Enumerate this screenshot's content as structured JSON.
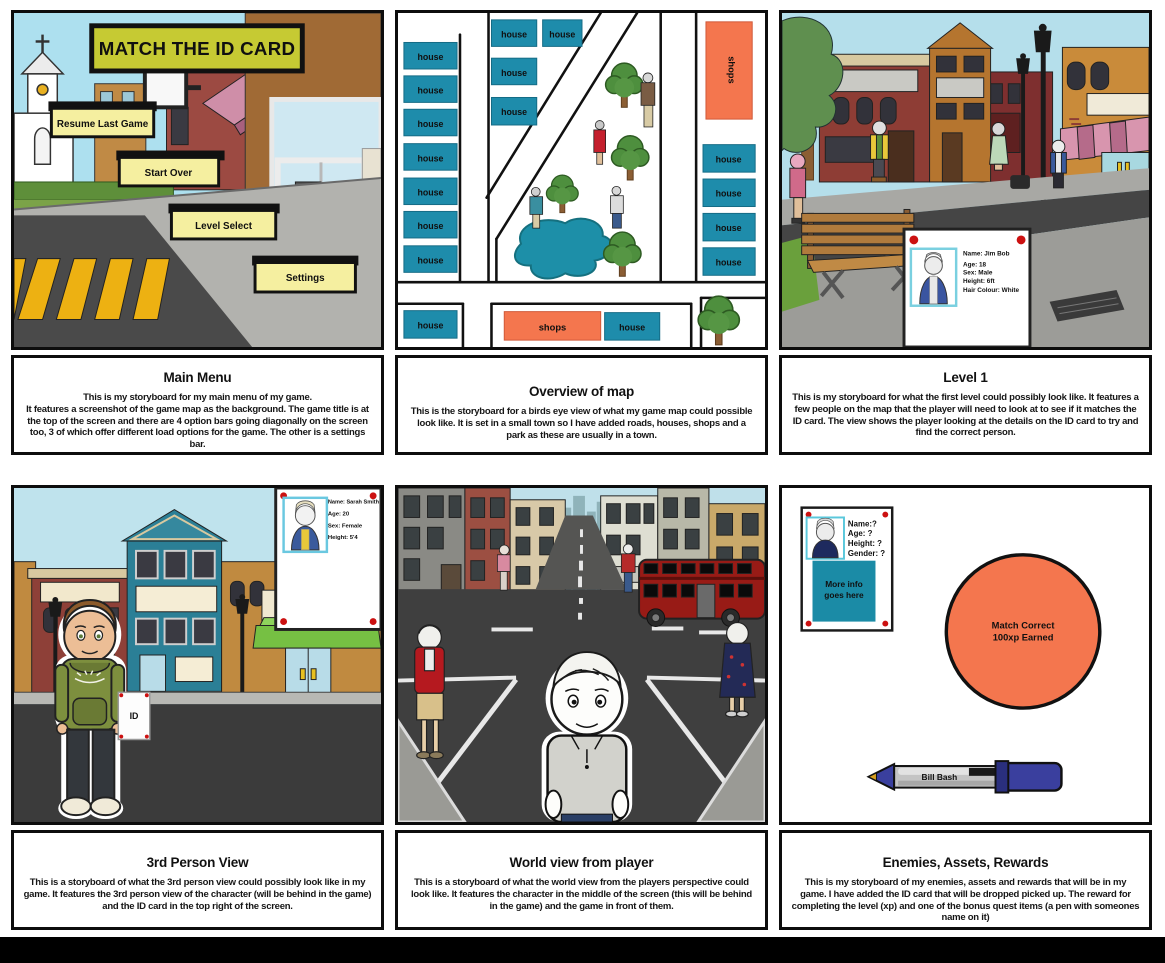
{
  "main_menu": {
    "scene_title": "MATCH THE ID CARD",
    "btn_resume": "Resume Last Game",
    "btn_start_over": "Start Over",
    "btn_level_select": "Level Select",
    "btn_settings": "Settings",
    "caption_title": "Main Menu",
    "caption_body": "This is my storyboard for my main menu of my game.\nIt features a screenshot of the game map as the background. The game title is at the top of the screen and there are 4 option bars going diagonally on the screen too, 3 of which offer different load options for the game. The other is a settings bar."
  },
  "map_overview": {
    "house_label": "house",
    "shops_label": "shops",
    "caption_title": "Overview of map",
    "caption_body": "This is the storyboard for a birds eye view of what my game map could possible look like. It is set in a small town so I have added roads, houses, shops and a park as these are usually in a town."
  },
  "level_one": {
    "id_card": {
      "name": "Name: Jim Bob",
      "age": "Age: 18",
      "sex": "Sex: Male",
      "height": "Height: 6ft",
      "hair": "Hair Colour: White"
    },
    "caption_title": "Level 1",
    "caption_body": "This is my storyboard for what the first level could possibly look like. It features a few people on the map that the player will need to look at to see if it matches the ID card. The view shows the player looking at the details on the ID card to try and find the correct person."
  },
  "third_person": {
    "id_tag": "ID",
    "id_card": {
      "name": "Name: Sarah Smith",
      "age": "Age: 20",
      "sex": "Sex: Female",
      "height": "Height: 5'4"
    },
    "caption_title": "3rd Person View",
    "caption_body": "This is a storyboard of what the 3rd person view could possibly look like in my game. It features the 3rd person view of the character (will be behind in the game) and the ID card in the top right of the screen."
  },
  "world_view": {
    "caption_title": "World view from player",
    "caption_body": "This is a storyboard of what the world view from the players perspective could look like. It features the character in the middle of the screen (this will be behind in the game) and the game in front of them."
  },
  "rewards": {
    "id_card": {
      "name": "Name:?",
      "age": "Age: ?",
      "height": "Height: ?",
      "gender": "Gender: ?",
      "info_line1": "More info",
      "info_line2": "goes here"
    },
    "reward_line1": "Match Correct",
    "reward_line2": "100xp Earned",
    "pen_label": "Bill Bash",
    "caption_title": "Enemies, Assets, Rewards",
    "caption_body": "This is my storyboard of my enemies, assets and rewards that will be in my game. I have added the ID card that will be dropped picked up. The reward for completing the level (xp) and one of the bonus quest items (a pen with someones name on it)"
  },
  "colors": {
    "house_teal": "#1e8cab",
    "shops_orange": "#f4764e",
    "button_yellow": "#f5efa0",
    "title_yellow": "#c6ca33",
    "reward_orange": "#f4764e",
    "pen_cap_blue": "#3a3f9e",
    "bus_red": "#981b16",
    "id_dot_red": "#cc1111"
  }
}
